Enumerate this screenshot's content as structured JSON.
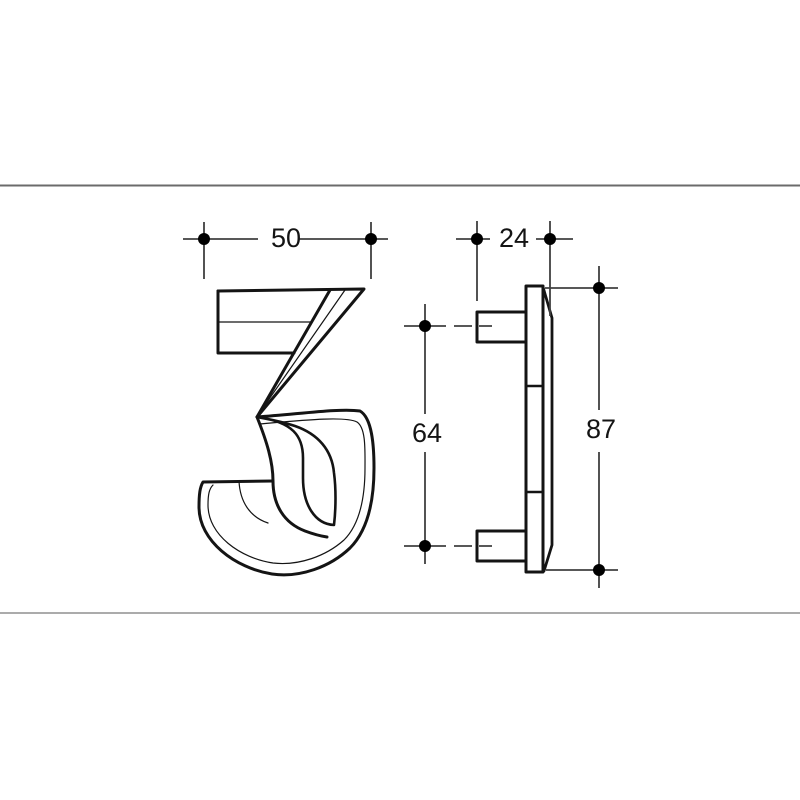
{
  "page": {
    "background_color": "#ffffff",
    "top_rule_color": "#6b6b6b",
    "bottom_rule_color": "#ababab"
  },
  "drawing": {
    "subject": "Technical dimension drawing of house number digit 3 - front view and side profile with two mounting studs",
    "ink_color": "#141414",
    "dimension_line_color": "#404040",
    "marker_dot_color": "#000000",
    "front_view": {
      "digit": "3",
      "width_mm": "50"
    },
    "side_view": {
      "depth_mm": "24",
      "stud_spacing_mm": "64",
      "height_mm": "87"
    }
  }
}
